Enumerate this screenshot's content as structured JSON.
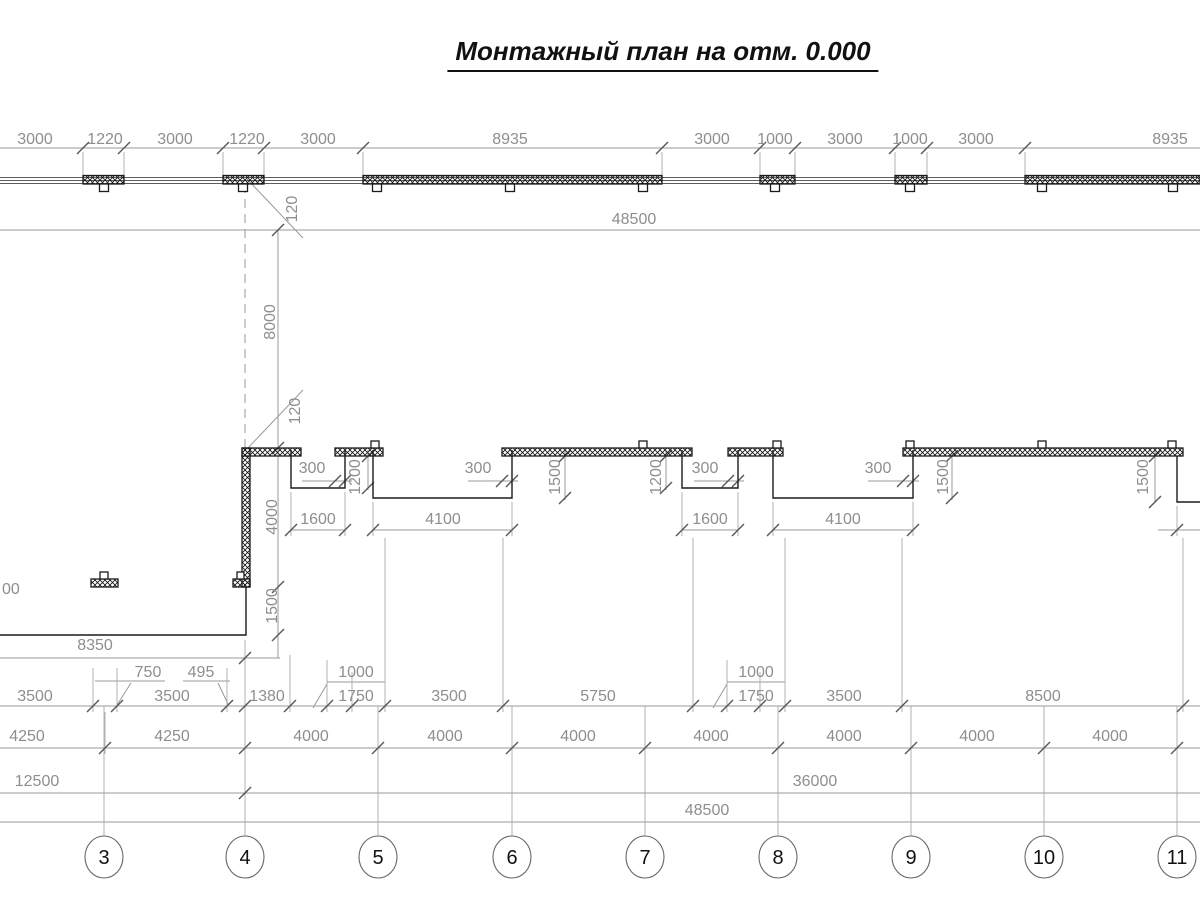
{
  "title": "Монтажный план на отм. 0.000",
  "top_dims": [
    "3000",
    "1220",
    "3000",
    "1220",
    "3000",
    "8935",
    "3000",
    "1000",
    "3000",
    "1000",
    "3000",
    "8935"
  ],
  "top_total": "48500",
  "mid": {
    "gap_top": "120",
    "bay_height": "8000",
    "gap_mid": "120",
    "wall_len": "4000",
    "wall_foot": "1500",
    "overhangs": [
      "300",
      "300",
      "300",
      "300"
    ],
    "niche_widths": [
      "1600",
      "4100",
      "1600",
      "4100"
    ],
    "niche_depths": [
      "1200",
      "1500",
      "1200",
      "1500",
      "1500"
    ],
    "left_partial": "00",
    "left_dim": "8350"
  },
  "detail_dims": {
    "d750": "750",
    "d495": "495",
    "left_1000": "1000",
    "left_1750": "1750",
    "right_1000": "1000",
    "right_1750": "1750"
  },
  "row_b": [
    "3500",
    "3500",
    "1380",
    "3500",
    "5750",
    "3500",
    "8500"
  ],
  "row_c": [
    "4250",
    "4250",
    "4000",
    "4000",
    "4000",
    "4000",
    "4000",
    "4000",
    "4000"
  ],
  "row_d_left": "12500",
  "row_d_right": "36000",
  "row_e": "48500",
  "axes": [
    "3",
    "4",
    "5",
    "6",
    "7",
    "8",
    "9",
    "10",
    "11"
  ],
  "colors": {
    "wall": "#1b1b1b",
    "dim_line": "#9a9a9a",
    "dim_text": "#8e8e8e"
  }
}
